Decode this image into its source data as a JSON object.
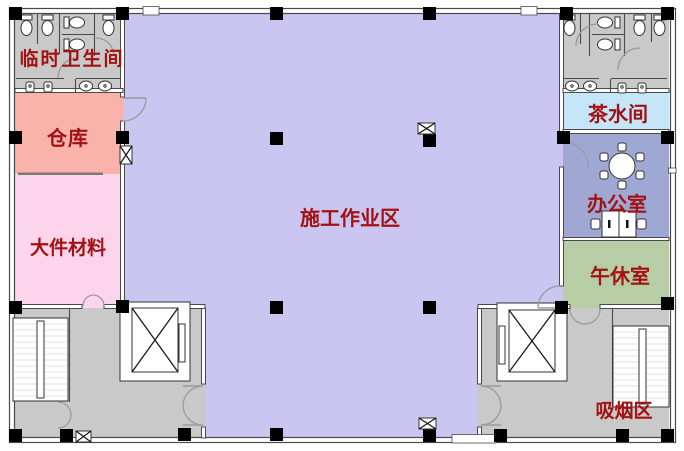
{
  "floorplan": {
    "type": "construction-site-floor-plan",
    "rooms": {
      "temporary_toilet": {
        "label": "临时卫生间",
        "color": "#c9c9c9"
      },
      "warehouse": {
        "label": "仓库",
        "color": "#f9b3aa"
      },
      "large_materials": {
        "label": "大件材料",
        "color": "#fcd5ec"
      },
      "construction_area": {
        "label": "施工作业区",
        "color": "#cbc5f2"
      },
      "tea_room": {
        "label": "茶水间",
        "color": "#c5e6f8"
      },
      "office": {
        "label": "办公室",
        "color": "#9ea8d2"
      },
      "nap_room": {
        "label": "午休室",
        "color": "#b6cda5"
      },
      "smoking_area": {
        "label": "吸烟区",
        "color": "#c9c9c9"
      }
    },
    "colors": {
      "label_text": "#a31212",
      "wall_line": "#4a4a4a",
      "column_fill": "#000000",
      "corridor_fill": "#c9c9c9",
      "door_arc": "#9a9aa0",
      "fixture_line": "#333333",
      "background": "#ffffff"
    },
    "symbols": {
      "column": "filled-black-square",
      "elevator": "box-with-x-cross",
      "staircase": "striped-treads-with-center-rail",
      "shaft_marker": "small-box-with-x",
      "door": "quarter-circle-swing-arc",
      "toilet": "oval-with-tank",
      "sink": "oval-basin",
      "round_table": "circle-with-six-chairs"
    }
  }
}
